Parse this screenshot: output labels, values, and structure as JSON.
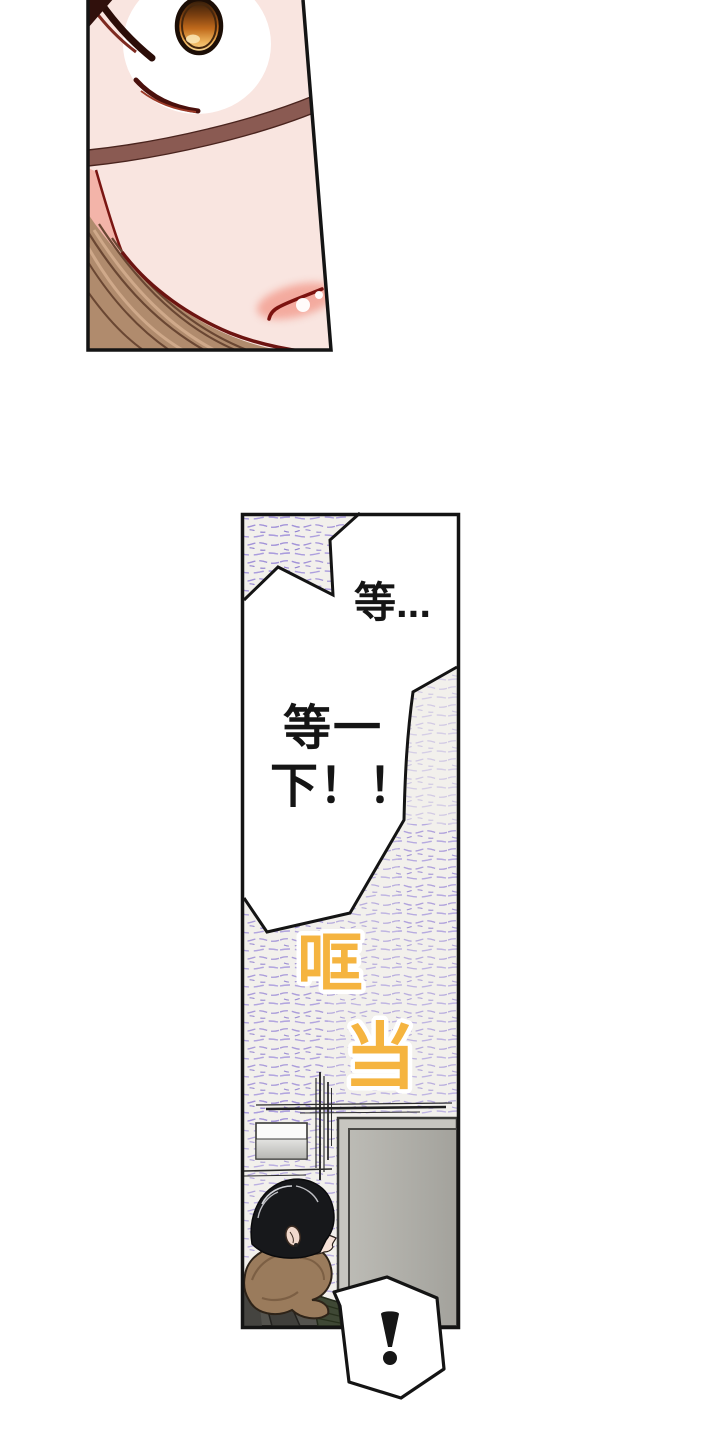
{
  "dialogue": {
    "wait_short": "等...",
    "wait_long_line1": "等一",
    "wait_long_line2": "下！！",
    "exclamation": "!"
  },
  "sfx": {
    "clang_1": "哐",
    "clang_2": "当",
    "color": "#f5b440"
  },
  "colors": {
    "page_bg": "#ffffff",
    "panel_border": "#141414",
    "panel_bg": "#f2f0ec",
    "scribble_purple": "#a091d8",
    "skin": "#f9e5e0",
    "iris_orange": "#c06a1c",
    "door_gray": "#b3b2ac",
    "female_hair": "#b08b6d",
    "boy_hair": "#17181b",
    "hood_brown": "#9a7b5c"
  }
}
